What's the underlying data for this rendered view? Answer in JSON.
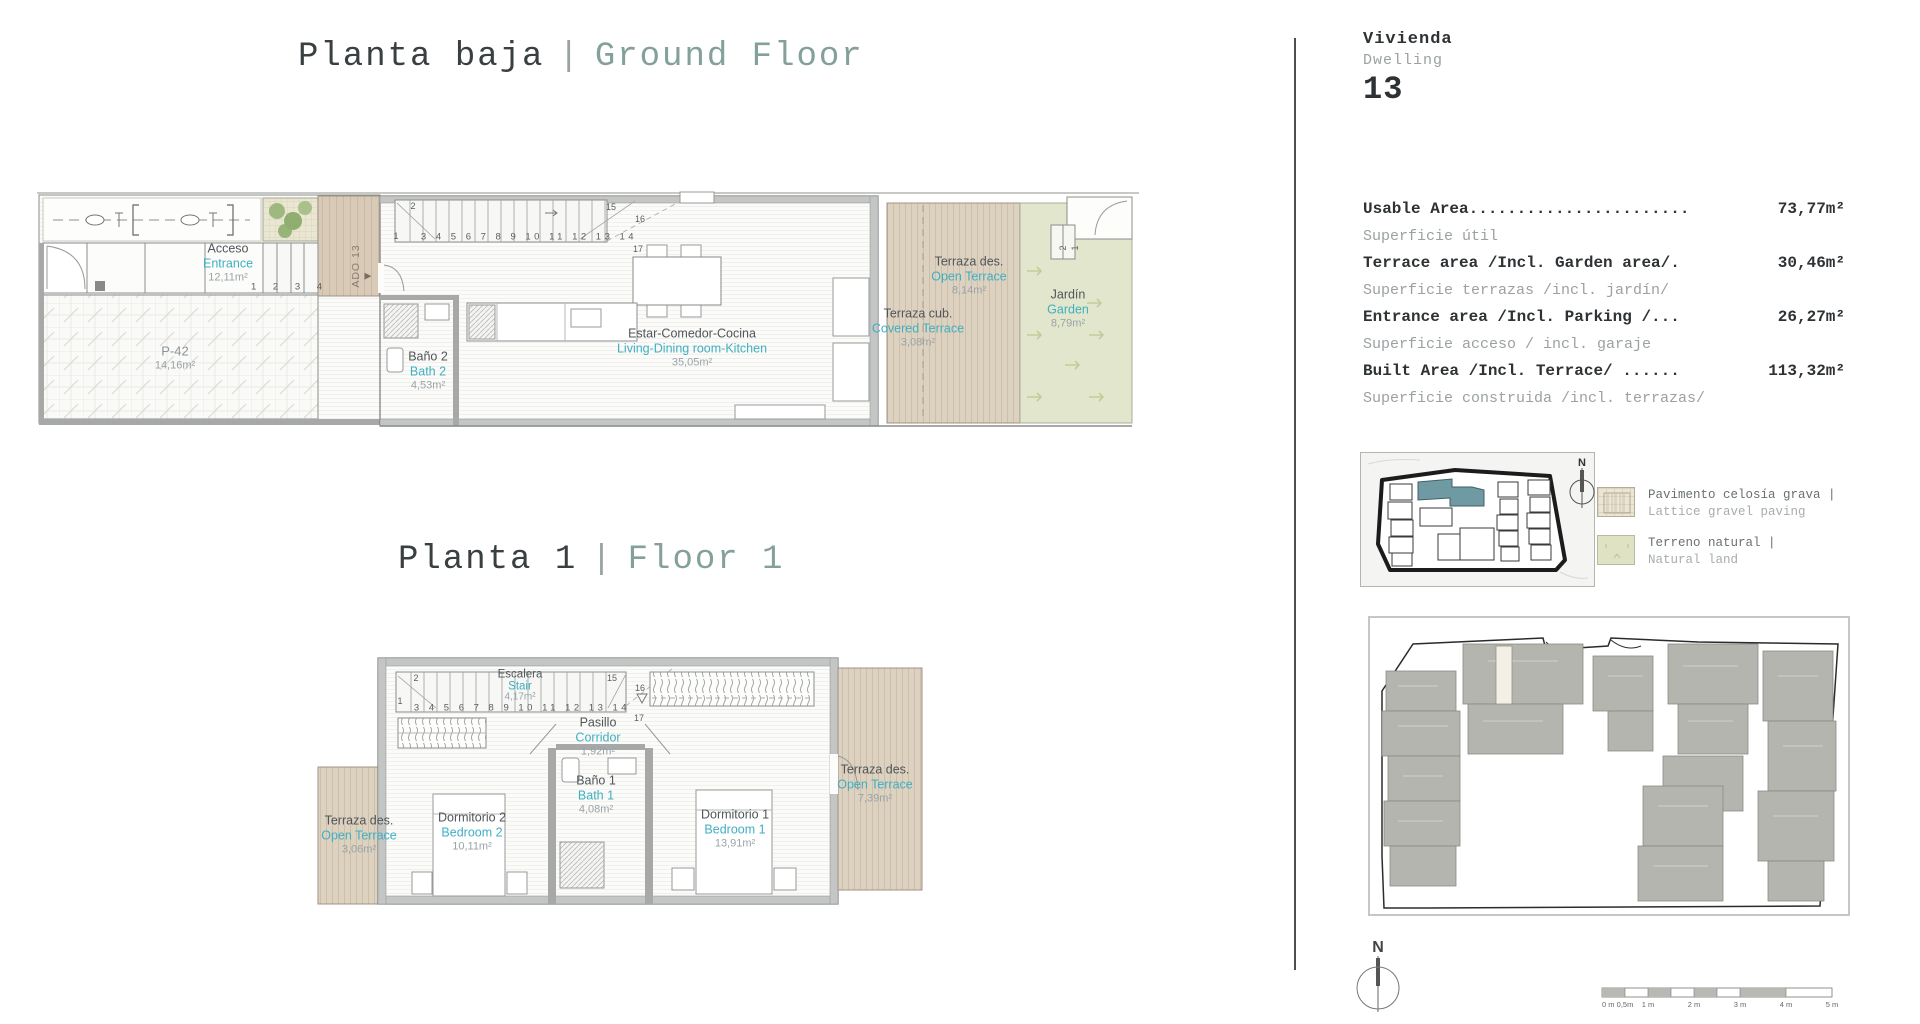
{
  "titles": {
    "ground": {
      "es": "Planta baja",
      "sep": "|",
      "en": "Ground Floor"
    },
    "first": {
      "es": "Planta 1",
      "sep": "|",
      "en": "Floor 1"
    }
  },
  "dwelling": {
    "label_es": "Vivienda",
    "label_en": "Dwelling",
    "number": "13"
  },
  "measurements": [
    {
      "en": "Usable Area.......................",
      "es": "Superficie útil",
      "value": "73,77m²"
    },
    {
      "en": "Terrace area /Incl. Garden area/.",
      "es": "Superficie terrazas /incl. jardín/",
      "value": "30,46m²"
    },
    {
      "en": "Entrance area /Incl. Parking /...",
      "es": "Superficie acceso / incl. garaje",
      "value": "26,27m²"
    },
    {
      "en": "Built Area /Incl. Terrace/ ......",
      "es": "Superficie construida /incl. terrazas/",
      "value": "113,32m²"
    }
  ],
  "legend": [
    {
      "es": "Pavimento celosía grava |",
      "en": "Lattice gravel paving"
    },
    {
      "es": "Terreno natural |",
      "en": "Natural land"
    }
  ],
  "compass": {
    "north": "N"
  },
  "scalebar": {
    "labels": [
      "0 m",
      "0,5m",
      "1 m",
      "2 m",
      "3 m",
      "4 m",
      "5 m"
    ]
  },
  "colors": {
    "accent_teal_text": "#3fafc2",
    "title_accent": "#83a09b",
    "terrace_beige": "#ddd1c0",
    "garden_green": "#e2e6cc",
    "keyplan_highlight": "#6f9aa4",
    "siteplan_gray": "#b5b5b0"
  },
  "ground_floor": {
    "entrance": {
      "es": "Acceso",
      "en": "Entrance",
      "area": "12,11m²"
    },
    "parking": {
      "name": "P-42",
      "area": "14,16m²"
    },
    "entry_marker": {
      "text": "ADO 13",
      "arrow": "▶"
    },
    "entry_steps": "1 2 3 4",
    "stair": {
      "row": "3 4 5 6 7 8 9 10 11 12 13 14",
      "n1": "1",
      "n2": "2",
      "n15": "15",
      "n16": "16",
      "n17": "17"
    },
    "bath2": {
      "es": "Baño 2",
      "en": "Bath 2",
      "area": "4,53m²"
    },
    "living": {
      "es": "Estar-Comedor-Cocina",
      "en": "Living-Dining room-Kitchen",
      "area": "35,05m²"
    },
    "open_terrace": {
      "es": "Terraza des.",
      "en": "Open Terrace",
      "area": "8,14m²"
    },
    "covered_terrace": {
      "es": "Terraza cub.",
      "en": "Covered Terrace",
      "area": "3,08m²"
    },
    "garden": {
      "es": "Jardín",
      "en": "Garden",
      "area": "8,79m²"
    },
    "garden_steps": {
      "n2": "2",
      "n1": "1"
    }
  },
  "first_floor": {
    "stair_room": {
      "es": "Escalera",
      "en": "Stair",
      "area": "4,17m²"
    },
    "stair": {
      "row": "3 4 5 6 7 8 9 10 11 12 13 14",
      "n1": "1",
      "n2": "2",
      "n15": "15",
      "n16": "16",
      "n17": "17"
    },
    "corridor": {
      "es": "Pasillo",
      "en": "Corridor",
      "area": "1,92m²"
    },
    "bath1": {
      "es": "Baño 1",
      "en": "Bath 1",
      "area": "4,08m²"
    },
    "bedroom2": {
      "es": "Dormitorio 2",
      "en": "Bedroom 2",
      "area": "10,11m²"
    },
    "bedroom1": {
      "es": "Dormitorio 1",
      "en": "Bedroom 1",
      "area": "13,91m²"
    },
    "terrace_left": {
      "es": "Terraza des.",
      "en": "Open Terrace",
      "area": "3,06m²"
    },
    "terrace_right": {
      "es": "Terraza des.",
      "en": "Open Terrace",
      "area": "7,39m²"
    }
  }
}
